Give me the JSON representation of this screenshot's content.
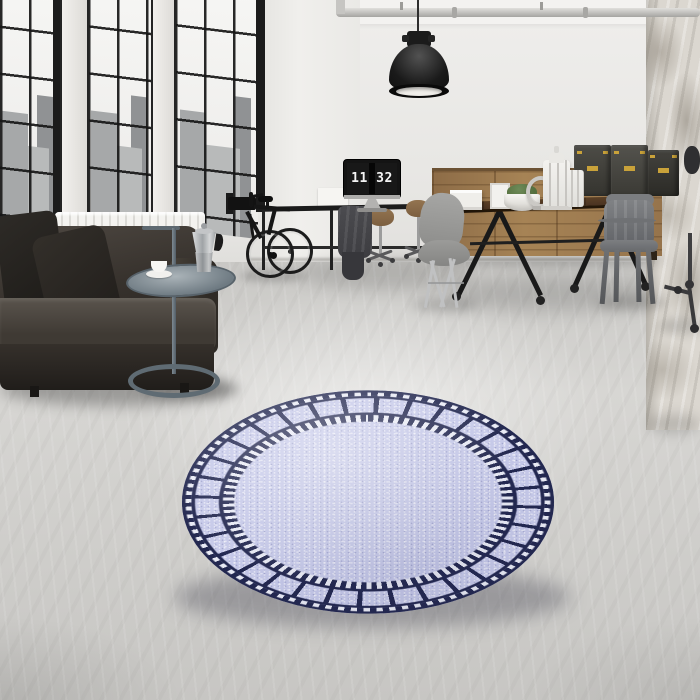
{
  "scene": {
    "type": "interior product photograph",
    "room": "industrial loft living space",
    "monitor_clock": "11 32",
    "objects": [
      "factory windows with city skyline view",
      "white radiator",
      "dark leather sofa with black cushions",
      "metal loop-base side table with moka pot and coffee cup",
      "black bicycle on wall rack",
      "desk with monitor showing flip clock",
      "office chairs on casters",
      "gray molded side chair",
      "industrial wood dining table on casters",
      "gunmetal metal armchair",
      "wooden sideboard with drawers",
      "dark storage trunks with brass latches",
      "white lanterns, frames and moss planter",
      "black industrial pendant lamp",
      "ceiling pipe",
      "distressed plaster corner wall",
      "rolling stool base",
      "round lavender rug with navy film-strip border"
    ]
  },
  "colors": {
    "wall": "#efeeec",
    "wall2": "#e7e6e3",
    "wall3": "#e1e0dd",
    "ceiling": "#f3f2f0",
    "floor": "#d7d6d3",
    "frame": "#1b1b1b",
    "sky": "#f6f6f4",
    "city": "#a6a8a9",
    "radiator": "#f4f3f0",
    "sofa": "#37322d",
    "pillow": "#1d1b18",
    "metal": "#6e7a82",
    "woodcab": "#a68355",
    "woodtable": "#4a3322",
    "chairgray": "#8e8e8c",
    "boxdark": "#3e3d37",
    "brass": "#c9a23a",
    "black": "#1b1b1b",
    "moss": "#55703f",
    "rugfield": "#c6c9e9",
    "rugnavy": "#232850",
    "rugdash": "#e9ebf5",
    "clock": "#f4f4f4"
  }
}
